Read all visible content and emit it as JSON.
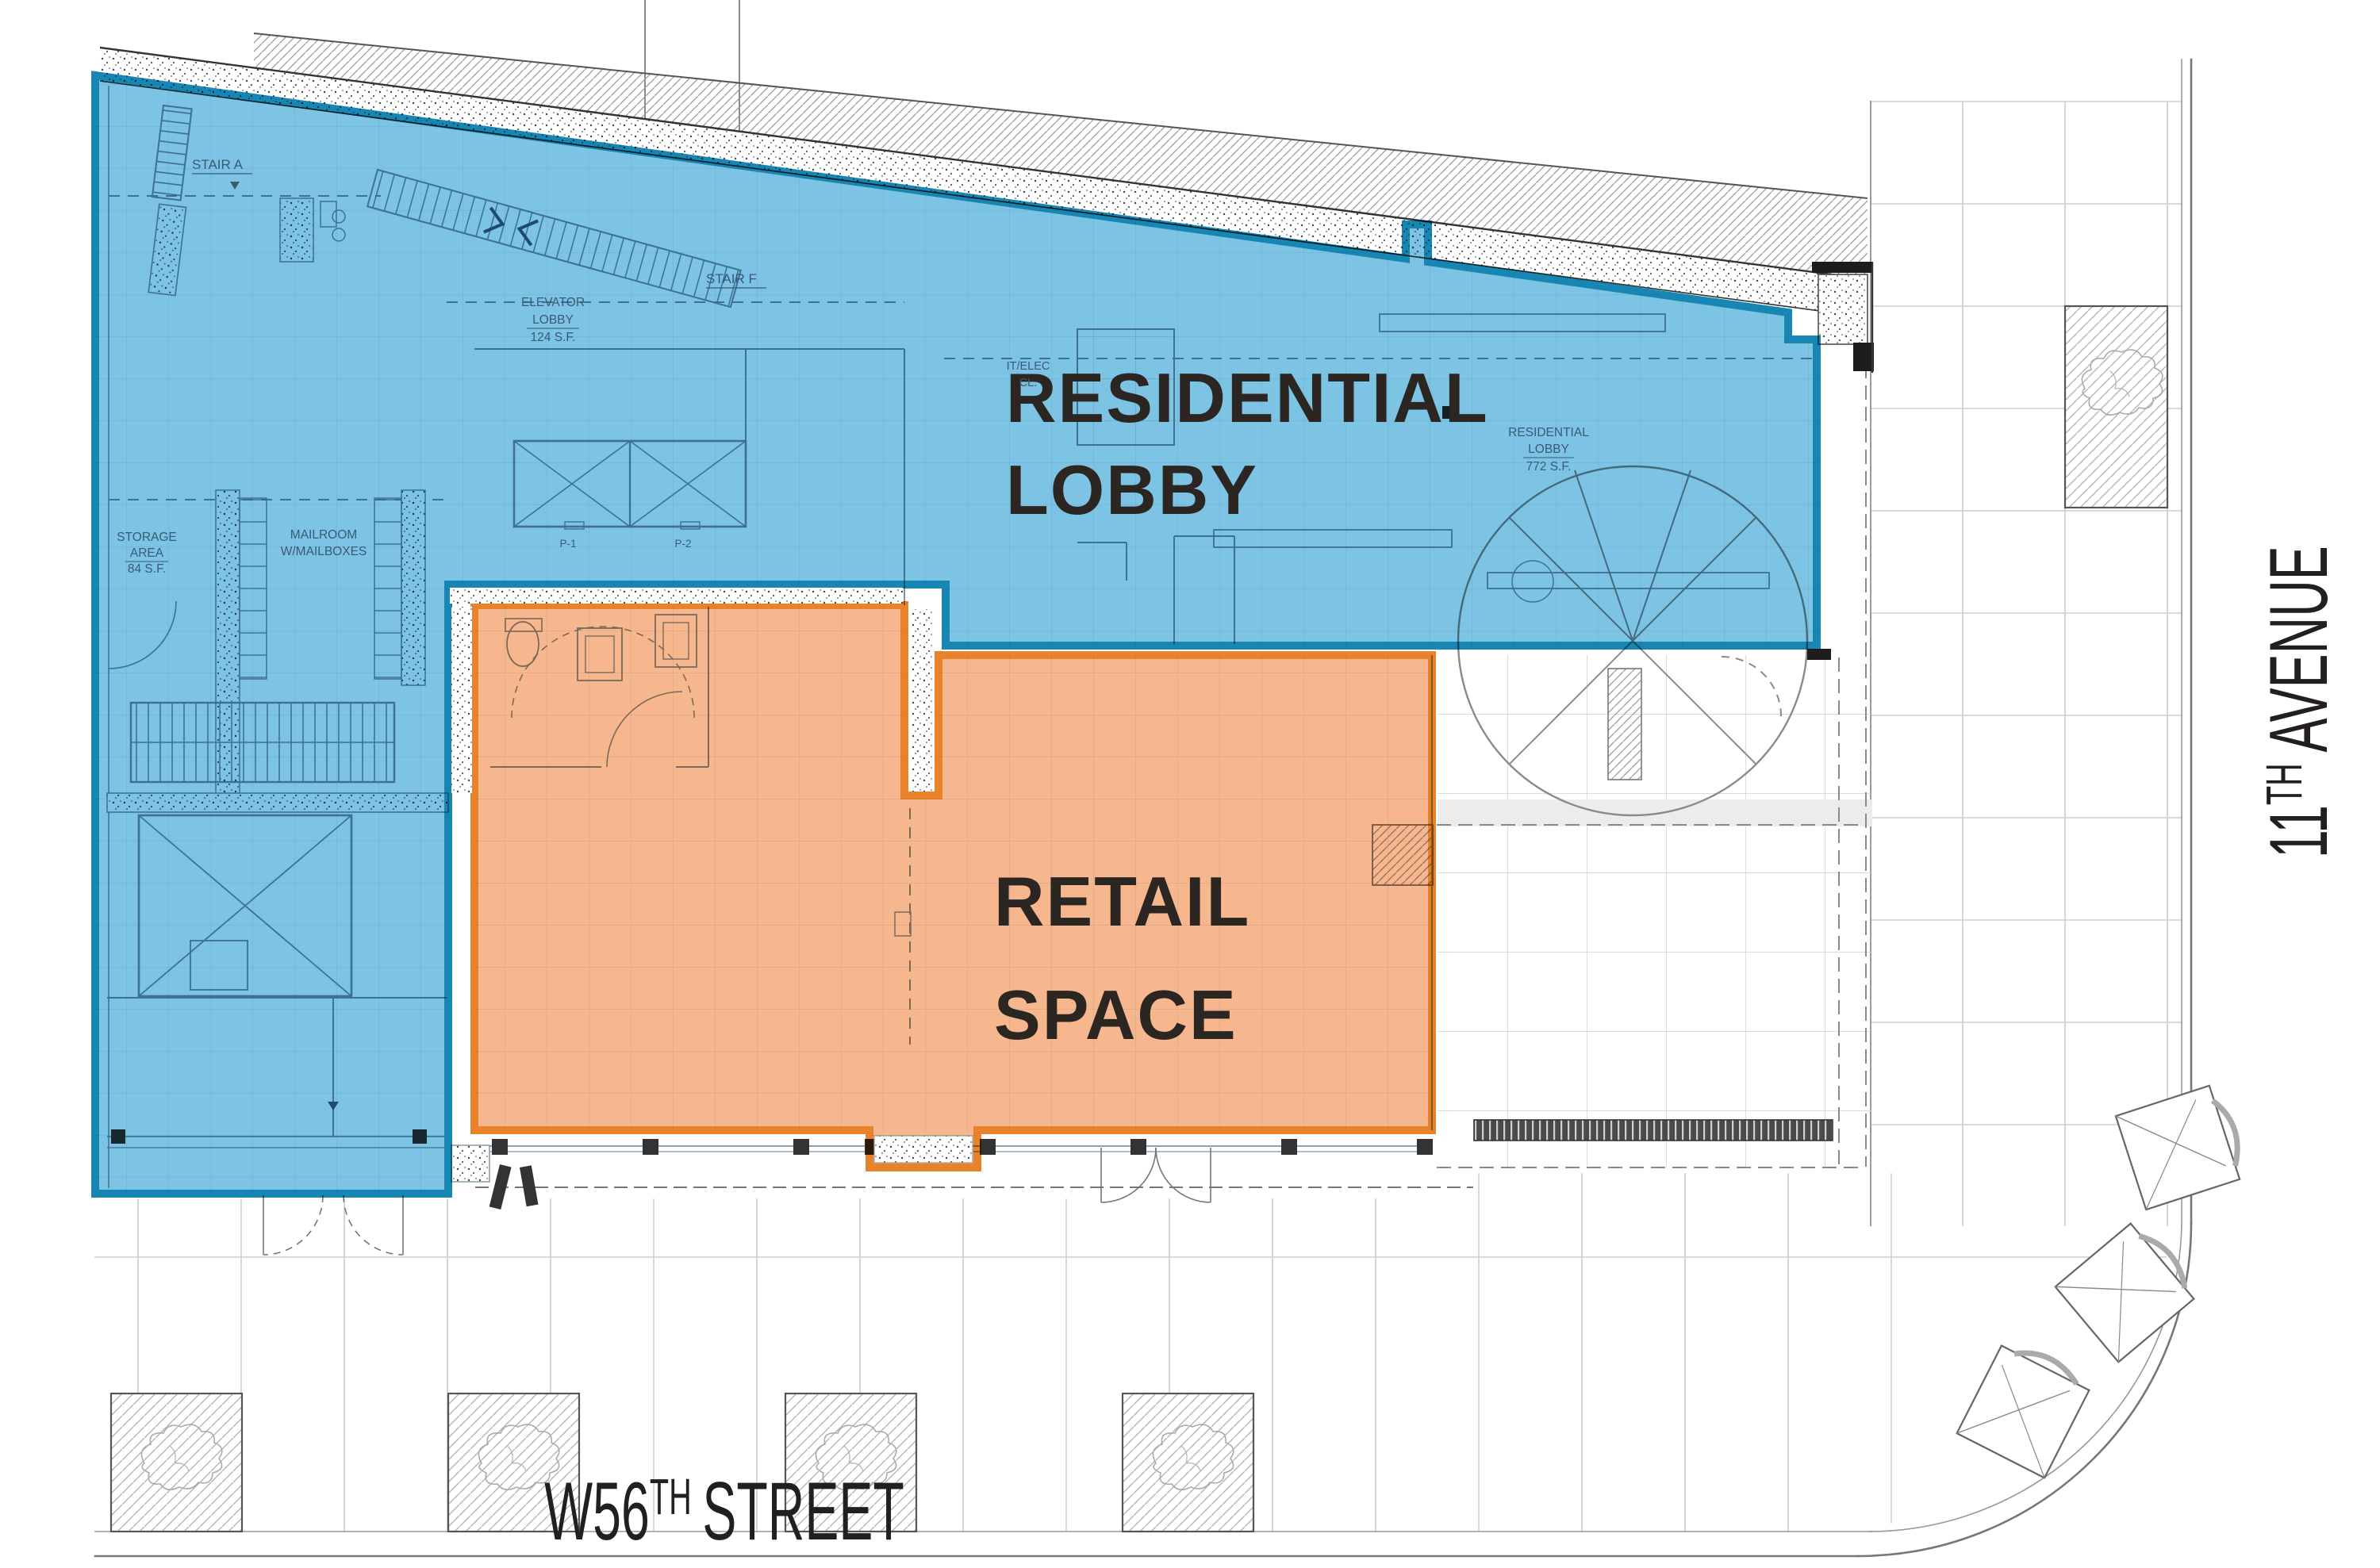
{
  "labels": {
    "residential_lobby": {
      "line1": "RESIDENTIAL",
      "line2": "LOBBY"
    },
    "retail_space": {
      "line1": "RETAIL",
      "line2": "SPACE"
    },
    "street": {
      "prefix": "W56",
      "sup": "TH",
      "rest": "STREET"
    },
    "avenue": {
      "prefix": "11",
      "sup": "TH",
      "rest": "AVENUE"
    }
  },
  "annotations": {
    "stair_a": "STAIR A",
    "stair_f": "STAIR F",
    "elevator_lobby": [
      "ELEVATOR",
      "LOBBY",
      "124 S.F."
    ],
    "it_elec": [
      "IT/ELEC",
      "CL."
    ],
    "residential_lobby_sm": [
      "RESIDENTIAL",
      "LOBBY",
      "772 S.F."
    ],
    "storage": [
      "STORAGE",
      "AREA",
      "84 S.F."
    ],
    "mailroom": [
      "MAILROOM",
      "W/MAILBOXES"
    ],
    "p1": "P-1",
    "p2": "P-2"
  },
  "colors": {
    "blue_fill": "#5FB6DE",
    "blue_border": "#1786B2",
    "orange_fill": "#F5A97A",
    "orange_border": "#E8822B",
    "label_dark": "#2B2622",
    "street_text": "#231F20",
    "plan_line": "#7E93A2"
  }
}
